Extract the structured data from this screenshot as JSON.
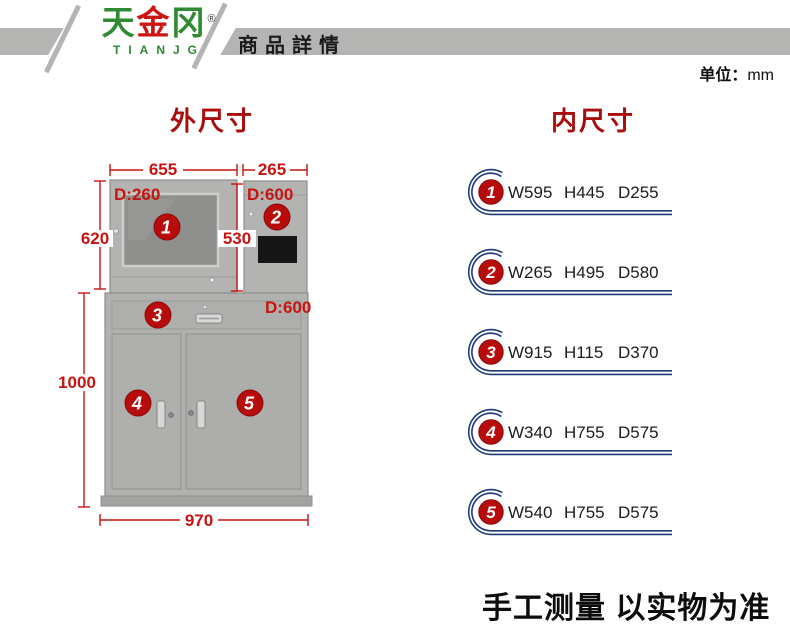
{
  "header": {
    "logo_char_1": "天",
    "logo_char_2": "金",
    "logo_char_3": "冈",
    "logo_reg": "®",
    "logo_latin": "TIANJG",
    "page_title": "商品詳情"
  },
  "unit": {
    "label": "单位：",
    "value": "mm"
  },
  "titles": {
    "outer": "外尺寸",
    "inner": "内尺寸"
  },
  "diagram": {
    "width_top_left": "655",
    "width_top_right": "265",
    "height_upper_left": "620",
    "height_upper_mid": "530",
    "height_lower": "1000",
    "width_bottom": "970",
    "depth_top_left": "D:260",
    "depth_top_right": "D:600",
    "depth_lower": "D:600",
    "marker_1": "1",
    "marker_2": "2",
    "marker_3": "3",
    "marker_4": "4",
    "marker_5": "5"
  },
  "specs": {
    "items": [
      {
        "num": "1",
        "w": "W595",
        "h": "H445",
        "d": "D255"
      },
      {
        "num": "2",
        "w": "W265",
        "h": "H495",
        "d": "D580"
      },
      {
        "num": "3",
        "w": "W915",
        "h": "H115",
        "d": "D370"
      },
      {
        "num": "4",
        "w": "W340",
        "h": "H755",
        "d": "D575"
      },
      {
        "num": "5",
        "w": "W540",
        "h": "H755",
        "d": "D575"
      }
    ]
  },
  "footer": {
    "note": "手工测量 以实物为准"
  },
  "colors": {
    "accent_red": "#c81310",
    "marker_red": "#b80c0c",
    "swirl_blue": "#1f3a78",
    "band_gray": "#b4b4b2",
    "logo_green": "#2f8a33"
  }
}
